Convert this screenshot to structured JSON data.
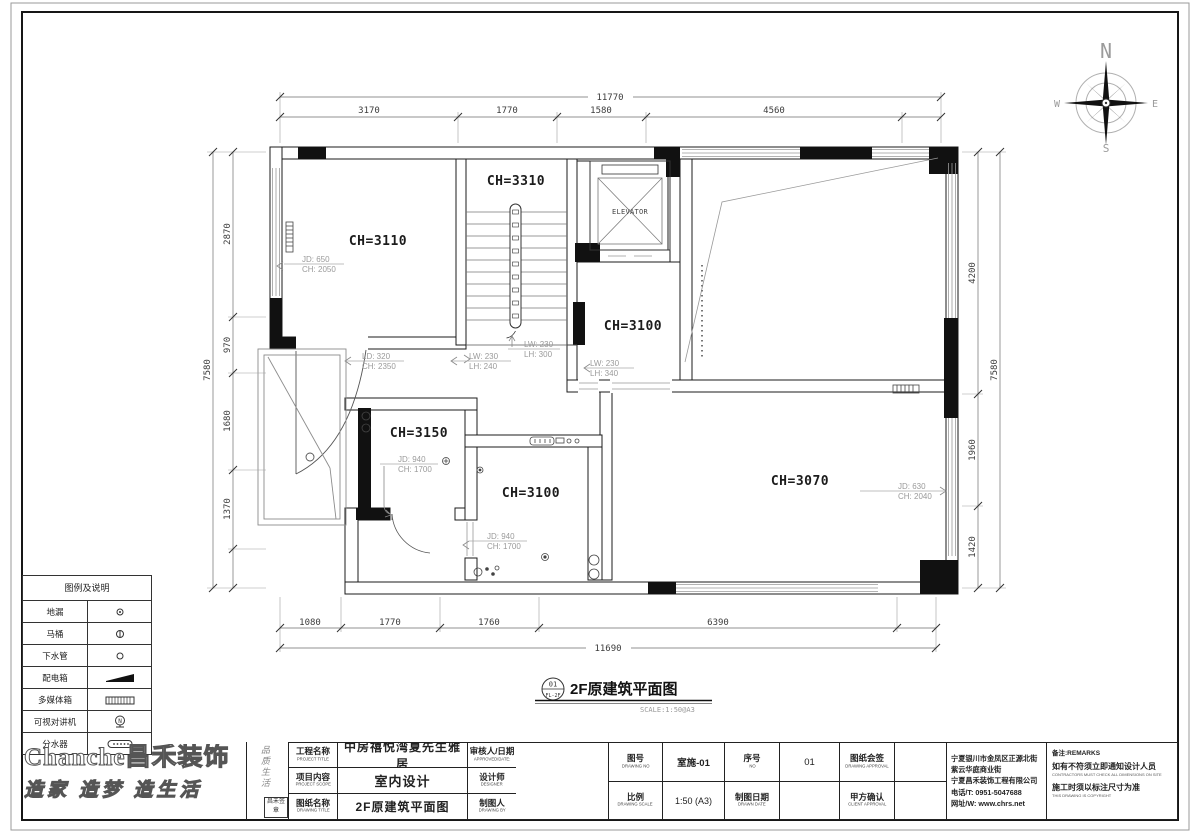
{
  "compass": {
    "n": "N",
    "e": "E",
    "s": "S",
    "w": "W"
  },
  "plan": {
    "rooms": [
      {
        "id": "stair",
        "label": "CH=3310"
      },
      {
        "id": "top-left",
        "label": "CH=3110"
      },
      {
        "id": "mid",
        "label": "CH=3100"
      },
      {
        "id": "left-small",
        "label": "CH=3150"
      },
      {
        "id": "bath",
        "label": "CH=3100"
      },
      {
        "id": "master",
        "label": "CH=3070"
      }
    ],
    "elevator": "ELEVATOR",
    "annotations": [
      {
        "l1": "JD: 650",
        "l2": "CH: 2050"
      },
      {
        "l1": "LD: 320",
        "l2": "CH: 2350"
      },
      {
        "l1": "LW: 230",
        "l2": "LH: 240"
      },
      {
        "l1": "LW: 230",
        "l2": "LH: 300"
      },
      {
        "l1": "LW: 230",
        "l2": "LH: 340"
      },
      {
        "l1": "JD: 940",
        "l2": "CH: 1700"
      },
      {
        "l1": "JD: 940",
        "l2": "CH: 1700"
      },
      {
        "l1": "JD: 630",
        "l2": "CH: 2040"
      }
    ],
    "dims": {
      "top": {
        "total": "11770",
        "segs": [
          "3170",
          "1770",
          "1580",
          "4560"
        ]
      },
      "bottom": {
        "total": "11690",
        "segs": [
          "1080",
          "1770",
          "1760",
          "6390"
        ]
      },
      "left": {
        "total": "7580",
        "segs": [
          "2870",
          "970",
          "1680",
          "1370"
        ]
      },
      "right": {
        "total": "7580",
        "segs": [
          "4200",
          "1960",
          "1420"
        ]
      }
    },
    "caption": {
      "num": "01",
      "sub": "FL-2F",
      "title": "2F原建筑平面图",
      "scale": "SCALE:1:50@A3"
    }
  },
  "legend": {
    "title": "图例及说明",
    "rows": [
      {
        "label": "地漏"
      },
      {
        "label": "马桶"
      },
      {
        "label": "下水管"
      },
      {
        "label": "配电箱"
      },
      {
        "label": "多媒体箱"
      },
      {
        "label": "可视对讲机"
      },
      {
        "label": "分水器"
      }
    ]
  },
  "titleblock": {
    "project_label": "工程名称",
    "project_label_en": "PROJECT TITLE",
    "project_value": "中房禧悦湾夏先生雅居",
    "scope_label": "项目内容",
    "scope_label_en": "PROJECT SCOPE",
    "scope_value": "室内设计",
    "dtitle_label": "图纸名称",
    "dtitle_label_en": "DRAWING TITLE",
    "dtitle_value": "2F原建筑平面图",
    "approved_label": "审核人/日期",
    "approved_label_en": "APPROVED/DATE:",
    "designer_label": "设计师",
    "designer_label_en": "DESIGNER",
    "drawnby_label": "制图人",
    "drawnby_label_en": "DRAWING BY",
    "no_label": "图号",
    "no_label_en": "DRAWING NO",
    "no_value": "室施-01",
    "seq_label": "序号",
    "seq_label_en": "NO",
    "seq_value": "01",
    "approval_label": "图纸会签",
    "approval_label_en": "DRAWING APPROVAL",
    "scale_label": "比例",
    "scale_label_en": "DRAWING SCALE",
    "scale_value": "1:50 (A3)",
    "date_label": "制图日期",
    "date_label_en": "DRAWN DATE",
    "client_label": "甲方确认",
    "client_label_en": "CLIENT APPROVAL",
    "company_lines": [
      "宁夏银川市金凤区正源北街",
      "紫云华庭商业街",
      "宁夏昌禾装饰工程有限公司",
      "电话/T: 0951-5047688",
      "网址/W: www.chrs.net"
    ],
    "remark_title": "备注:REMARKS",
    "remark1": "如有不符须立即通知设计人员",
    "remark1_en": "CONTRACTORS MUST CHECK ALL DIMENSIONS ON SITE",
    "remark2": "施工时须以标注尺寸为准",
    "remark2_en": "THIS DRAWING IS COPYRIGHT"
  },
  "logo": {
    "latin": "Chanche",
    "cn": "昌禾装饰",
    "slogan": "造家 造梦 造生活",
    "side": "品质生活",
    "seal": "昌禾签章"
  }
}
